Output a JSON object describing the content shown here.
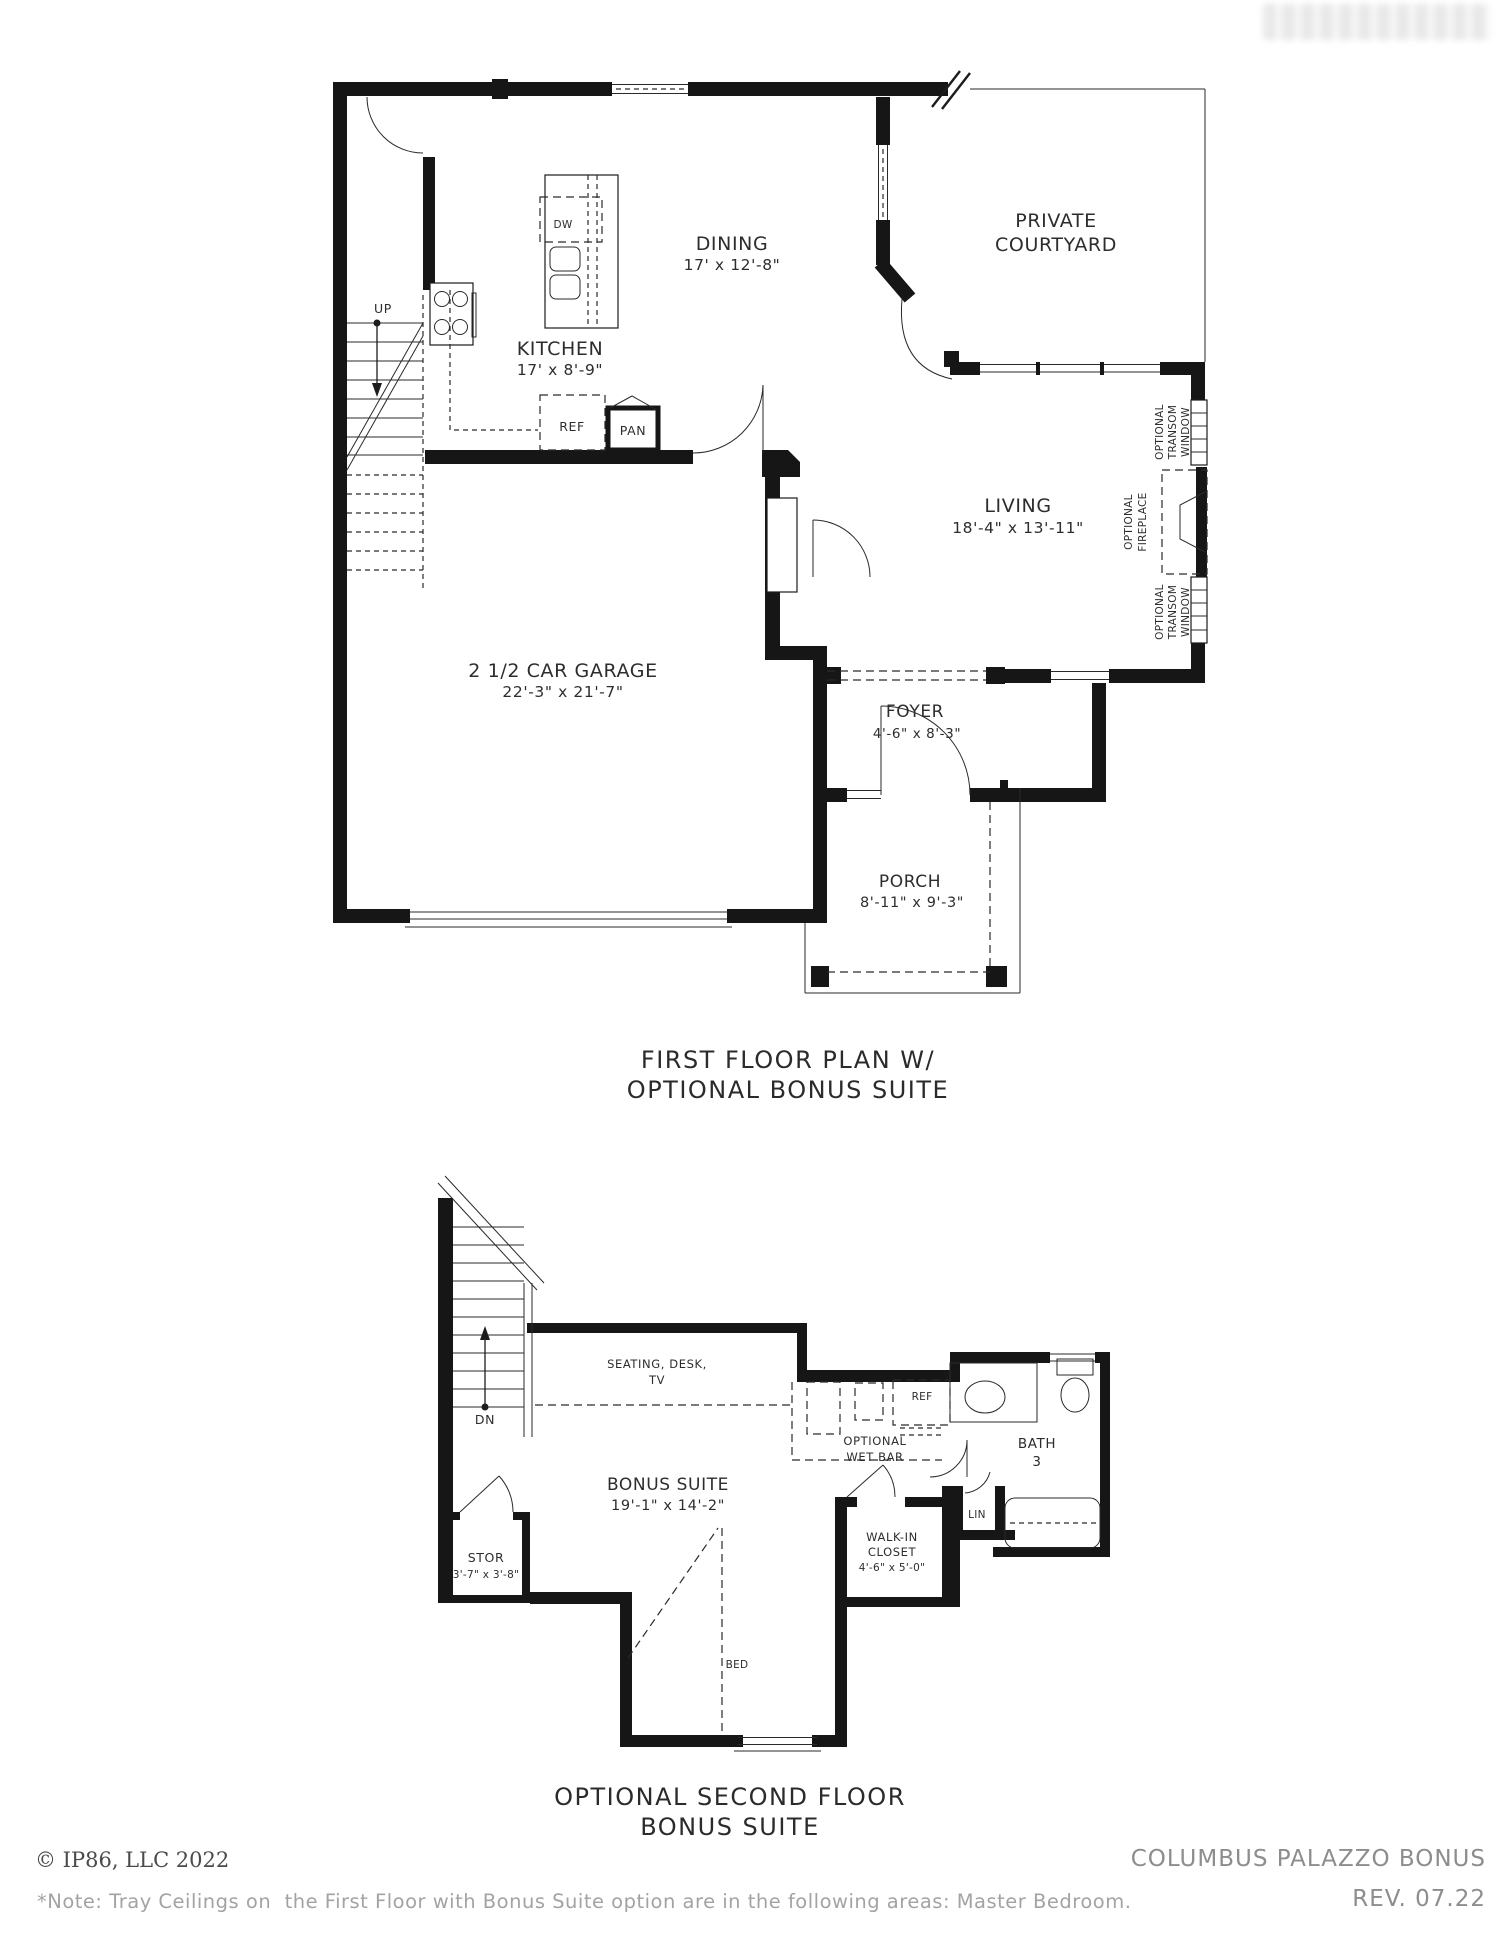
{
  "page": {
    "first_floor_plan": {
      "title_line1": "FIRST FLOOR PLAN W/",
      "title_line2": "OPTIONAL BONUS SUITE",
      "rooms": {
        "dining": {
          "name": "DINING",
          "dims": "17' x 12'-8\""
        },
        "courtyard": {
          "name_line1": "PRIVATE",
          "name_line2": "COURTYARD"
        },
        "kitchen": {
          "name": "KITCHEN",
          "dims": "17' x 8'-9\""
        },
        "living": {
          "name": "LIVING",
          "dims": "18'-4\" x 13'-11\""
        },
        "garage": {
          "name": "2 1/2 CAR GARAGE",
          "dims": "22'-3\" x 21'-7\""
        },
        "foyer": {
          "name": "FOYER",
          "dims": "4'-6\" x 8'-3\""
        },
        "porch": {
          "name": "PORCH",
          "dims": "8'-11\" x 9'-3\""
        }
      },
      "annotations": {
        "up": "UP",
        "dw": "DW",
        "ref": "REF",
        "pan": "PAN",
        "optional": "OPTIONAL",
        "transom": "TRANSOM",
        "window": "WINDOW",
        "fireplace": "FIREPLACE"
      }
    },
    "second_floor_plan": {
      "title_line1": "OPTIONAL SECOND FLOOR",
      "title_line2": "BONUS SUITE",
      "rooms": {
        "bonus": {
          "name": "BONUS SUITE",
          "dims": "19'-1\" x 14'-2\""
        },
        "bath": {
          "name": "BATH",
          "number": "3"
        },
        "stor": {
          "name": "STOR",
          "dims": "3'-7\" x 3'-8\""
        },
        "walkin": {
          "line1": "WALK-IN",
          "line2": "CLOSET",
          "dims": "4'-6\" x 5'-0\""
        }
      },
      "annotations": {
        "dn": "DN",
        "ref": "REF",
        "lin": "LIN",
        "bed": "BED",
        "seating_line1": "SEATING, DESK,",
        "seating_line2": "TV",
        "wetbar_line1": "OPTIONAL",
        "wetbar_line2": "WET BAR"
      }
    },
    "footer": {
      "copyright": "© IP86, LLC 2022",
      "note": "*Note: Tray Ceilings on  the First Floor with Bonus Suite option are in the following areas: Master Bedroom.",
      "plan_name": "COLUMBUS PALAZZO BONUS",
      "revision": "REV. 07.22"
    }
  }
}
